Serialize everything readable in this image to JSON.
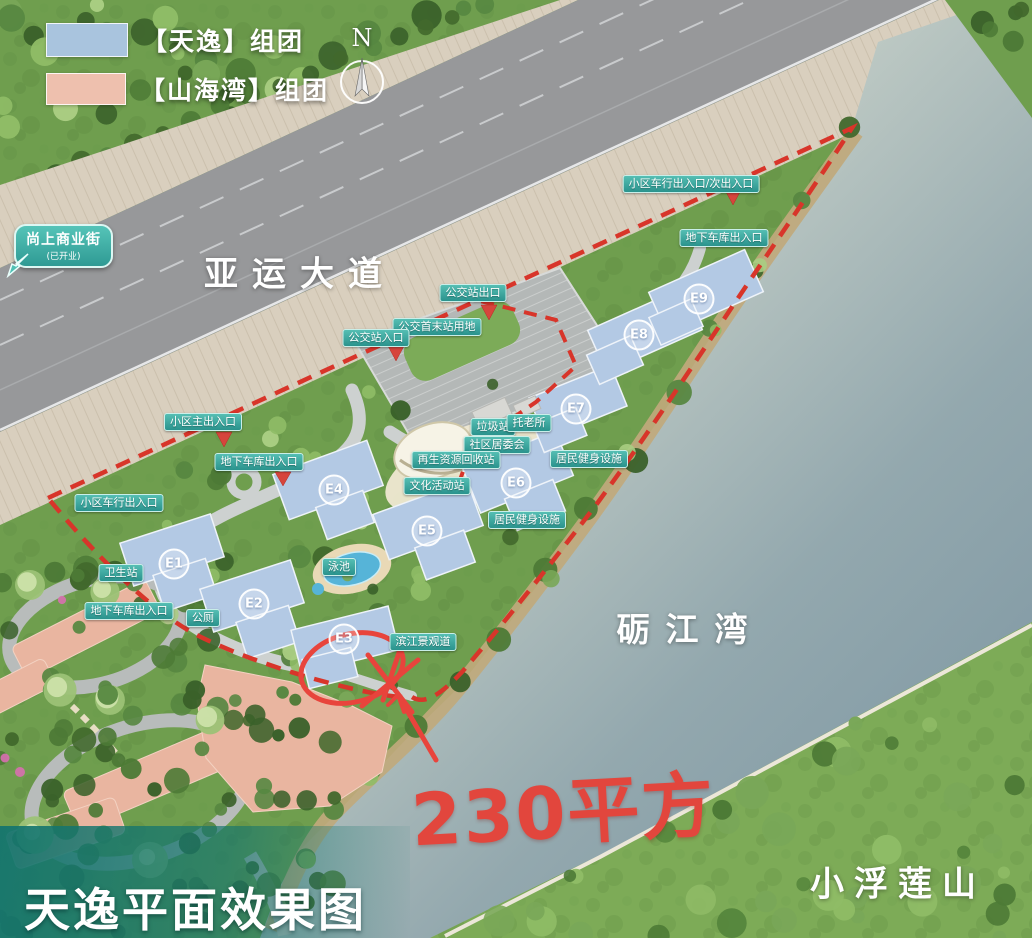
{
  "title": {
    "text": "天逸平面效果图"
  },
  "legend": {
    "items": [
      {
        "swatch_color": "#a9c4de",
        "label": "【天逸】组团"
      },
      {
        "swatch_color": "#eec0ae",
        "label": "【山海湾】组团"
      }
    ]
  },
  "compass": {
    "label": "N"
  },
  "callout_shop": {
    "title": "尚上商业街",
    "subtitle": "(已开业)"
  },
  "place_labels": {
    "road": "亚运大道",
    "river": "砺江湾",
    "mountain": "小浮莲山"
  },
  "annotation": {
    "text": "230平方",
    "color": "#e2463d"
  },
  "buildings": [
    "E1",
    "E2",
    "E3",
    "E4",
    "E5",
    "E6",
    "E7",
    "E8",
    "E9"
  ],
  "badges": [
    {
      "text": "公交站出口"
    },
    {
      "text": "公交首末站用地"
    },
    {
      "text": "公交站入口"
    },
    {
      "text": "小区车行出入口/次出入口"
    },
    {
      "text": "地下车库出入口"
    },
    {
      "text": "小区主出入口"
    },
    {
      "text": "地下车库出入口"
    },
    {
      "text": "小区车行出入口"
    },
    {
      "text": "垃圾站"
    },
    {
      "text": "托老所"
    },
    {
      "text": "社区居委会"
    },
    {
      "text": "再生资源回收站"
    },
    {
      "text": "文化活动站"
    },
    {
      "text": "居民健身设施"
    },
    {
      "text": "居民健身设施"
    },
    {
      "text": "卫生站"
    },
    {
      "text": "地下车库出入口"
    },
    {
      "text": "公厕"
    },
    {
      "text": "泳池"
    },
    {
      "text": "滨江景观道"
    }
  ],
  "colors": {
    "badge_teal": "#35a39c",
    "boundary_red": "#d8352a",
    "annotation_red": "#e8443c",
    "building_blue": "#b3c9e4",
    "shanhaiwan_pink": "#e9b5a0",
    "water_gray": "#8ba4a4",
    "road_gray": "#97989a"
  }
}
